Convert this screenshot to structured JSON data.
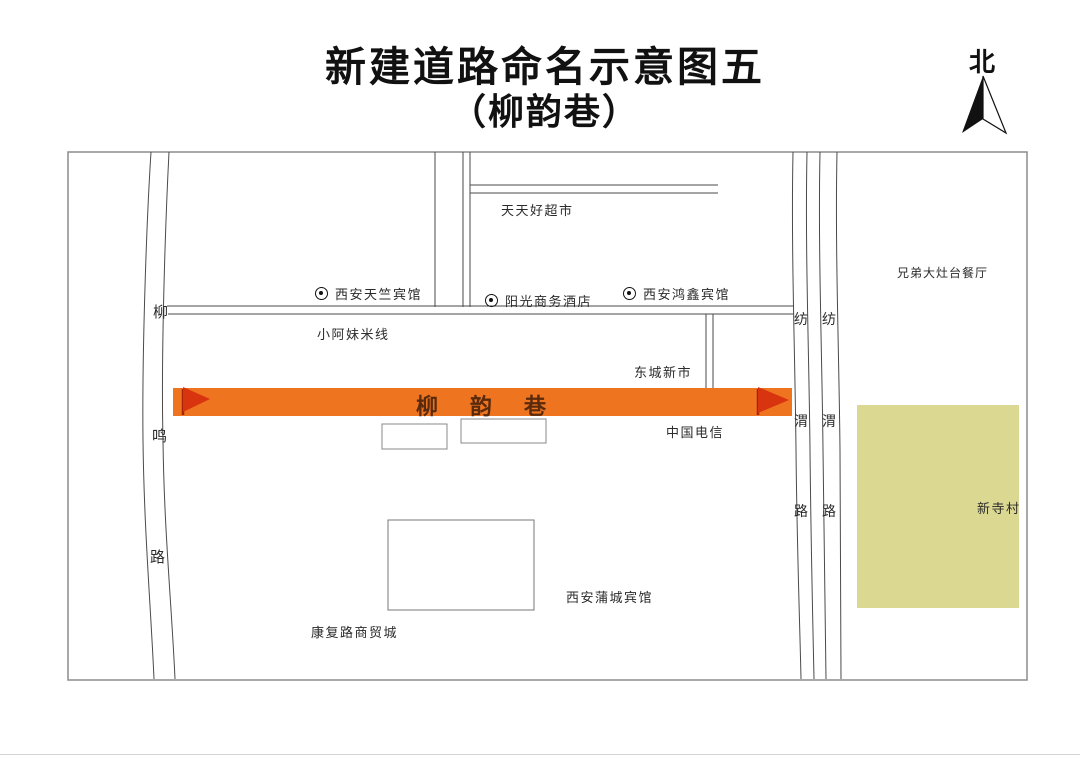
{
  "title": {
    "line1": "新建道路命名示意图五",
    "line2": "（柳韵巷）"
  },
  "compass": {
    "label": "北"
  },
  "highlight_road": {
    "name": "柳韵巷",
    "flag_color": "#d93410",
    "road_color": "#ee7420",
    "name_color": "#5a2a0c"
  },
  "roads": {
    "left_vertical": {
      "name": "柳鸣路",
      "chars": [
        "柳",
        "鸣",
        "路"
      ]
    },
    "right_vertical_west": {
      "name": "纺渭路",
      "chars": [
        "纺",
        "渭",
        "路"
      ]
    },
    "right_vertical_east": {
      "name": "纺渭路",
      "chars": [
        "纺",
        "渭",
        "路"
      ]
    }
  },
  "pois": {
    "supermarket": "天天好超市",
    "tianzhu_hotel": "西安天竺宾馆",
    "sunshine_hotel": "阳光商务酒店",
    "hongxin_hotel": "西安鸿鑫宾馆",
    "noodle_shop": "小阿妹米线",
    "dongcheng_market": "东城新市",
    "china_telecom": "中国电信",
    "brothers_restaurant": "兄弟大灶台餐厅",
    "xinsi_village": "新寺村",
    "pucheng_hotel": "西安蒲城宾馆",
    "kangfu_trade_city": "康复路商贸城"
  },
  "colors": {
    "map_border": "#8c8c8c",
    "map_line": "#4a4a4a",
    "village_fill": "#dbd892",
    "background": "#ffffff"
  }
}
